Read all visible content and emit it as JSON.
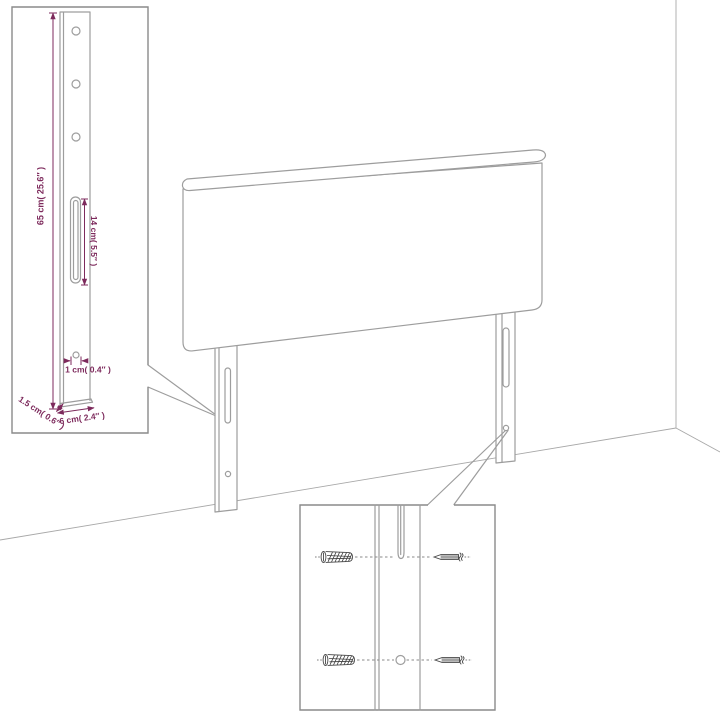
{
  "diagram": {
    "kind": "headboard-assembly-dimension-diagram",
    "leg_detail_inset": {
      "dim_height": "65 cm( 25.6″ )",
      "dim_slot": "14 cm( 5.5″ )",
      "dim_hole": "1 cm( 0.4″ )",
      "dim_depth": "1.5 cm( 0.6″ )",
      "dim_width": "6 cm( 2.4″ )"
    },
    "hardware_detail_inset": {
      "icons": [
        "wall-plug-icon",
        "screw-icon"
      ]
    },
    "colors": {
      "background": "#ffffff",
      "line": "#9d9d9d",
      "inset_border": "#8a8a8a",
      "dimension_text": "#7d2a5c",
      "hardware": "#474747"
    }
  }
}
